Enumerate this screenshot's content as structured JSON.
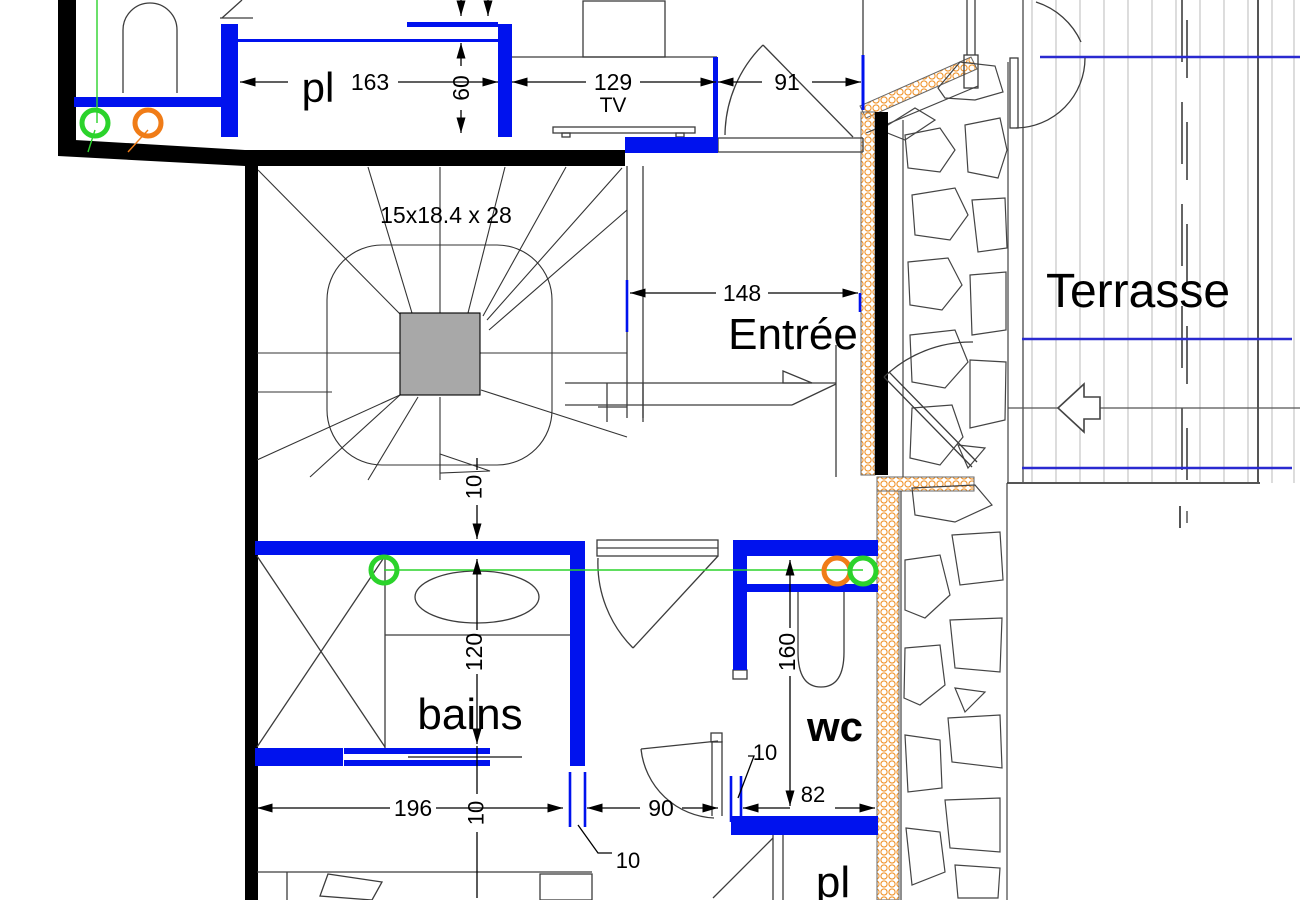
{
  "drawing": {
    "type": "architectural-floor-plan",
    "room_labels": {
      "closet_top": "pl",
      "entry": "Entrée",
      "terrace": "Terrasse",
      "bath": "bains",
      "wc": "wc",
      "closet_bottom": "pl"
    },
    "stair_note": "15x18.4 x 28",
    "fixture_labels": {
      "tv": "TV"
    },
    "dimensions": {
      "d163": "163",
      "d60": "60",
      "d129": "129",
      "d91": "91",
      "d148": "148",
      "d10_stair": "10",
      "d120": "120",
      "d160": "160",
      "d196": "196",
      "d10_bath": "10",
      "d90": "90",
      "d10_leader_left": "10",
      "d10_leader_right": "10",
      "d82": "82"
    },
    "colors": {
      "wall_blue": "#0012ee",
      "wall_black": "#000000",
      "line_gray": "#3c3c3c",
      "deck_gray": "#c6c6c6",
      "terrace_blue": "#2a2ad0",
      "insulation_orange": "#f0952f",
      "marker_green": "#2bd32b",
      "marker_orange": "#f07c17",
      "newel_gray": "#a8a8a8"
    },
    "annotations": {
      "green_markers": 3,
      "orange_markers": 2
    }
  }
}
